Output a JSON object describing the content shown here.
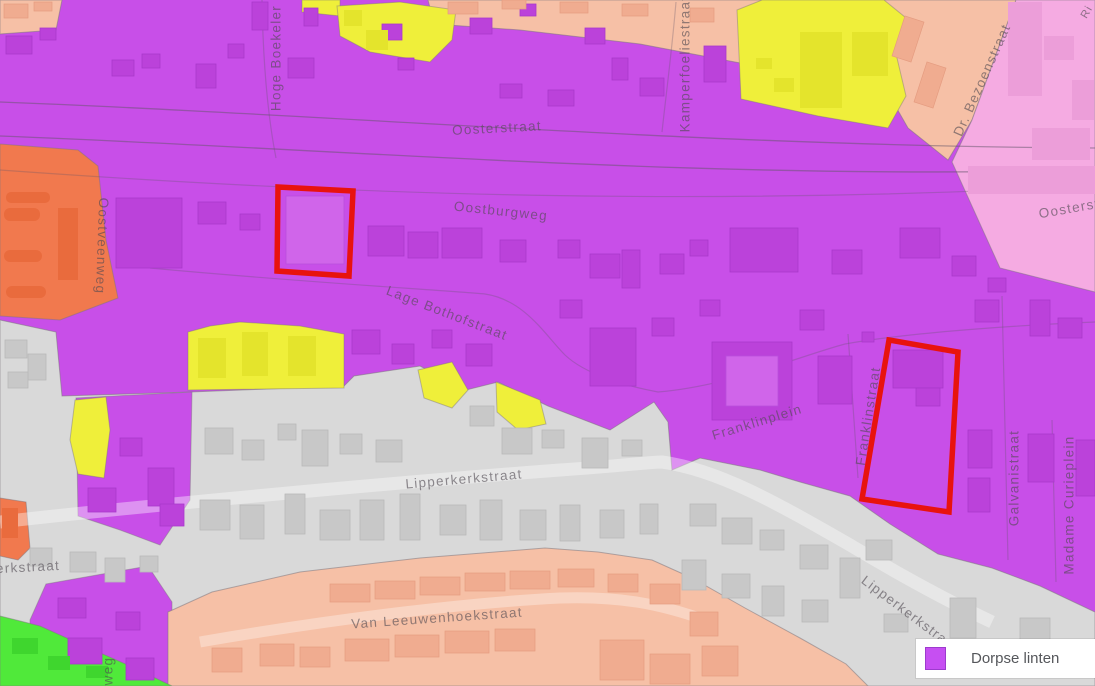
{
  "map": {
    "type": "zoning-map",
    "legend": {
      "label": "Dorpse linten",
      "swatch_color": "#c64ff2"
    },
    "street_labels": {
      "oosterstraat": "Oosterstraat",
      "oostburgweg": "Oostburgweg",
      "lage_bothofstraat": "Lage Bothofstraat",
      "lipperkerkstraat": "Lipperkerkstraat",
      "lipperkerkstraat_bottom_right": "Lipperkerkstraat",
      "lipperkerkstraat_left_edge": "erkstraat",
      "van_leeuwenhoekstraat": "Van Leeuwenhoekstraat",
      "hoge_boekeler": "Hoge Boekeler",
      "kamperfoeliestraat": "Kamperfoeliestraat",
      "dr_bezoenstraat": "Dr. Bezoenstraat",
      "oosterstraat_right": "Oosterstr",
      "oostveenweg": "Oostveenweg",
      "franklinplein": "Franklinplein",
      "franklinstraat": "Franklinstraat",
      "galvanistraat": "Galvanistraat",
      "madame_curieplein": "Madame Curieplein",
      "weg_partial": "weg",
      "ri_partial": "Ri"
    },
    "zone_colors": {
      "dorpse_linten": "#c84fe8",
      "yellow": "#efef3a",
      "orange": "#f1794e",
      "salmon": "#f6c0a6",
      "pink": "#f5abe2",
      "gray": "#d9d9d9",
      "green": "#50e93a",
      "highlight_outline": "#e8130e"
    }
  }
}
